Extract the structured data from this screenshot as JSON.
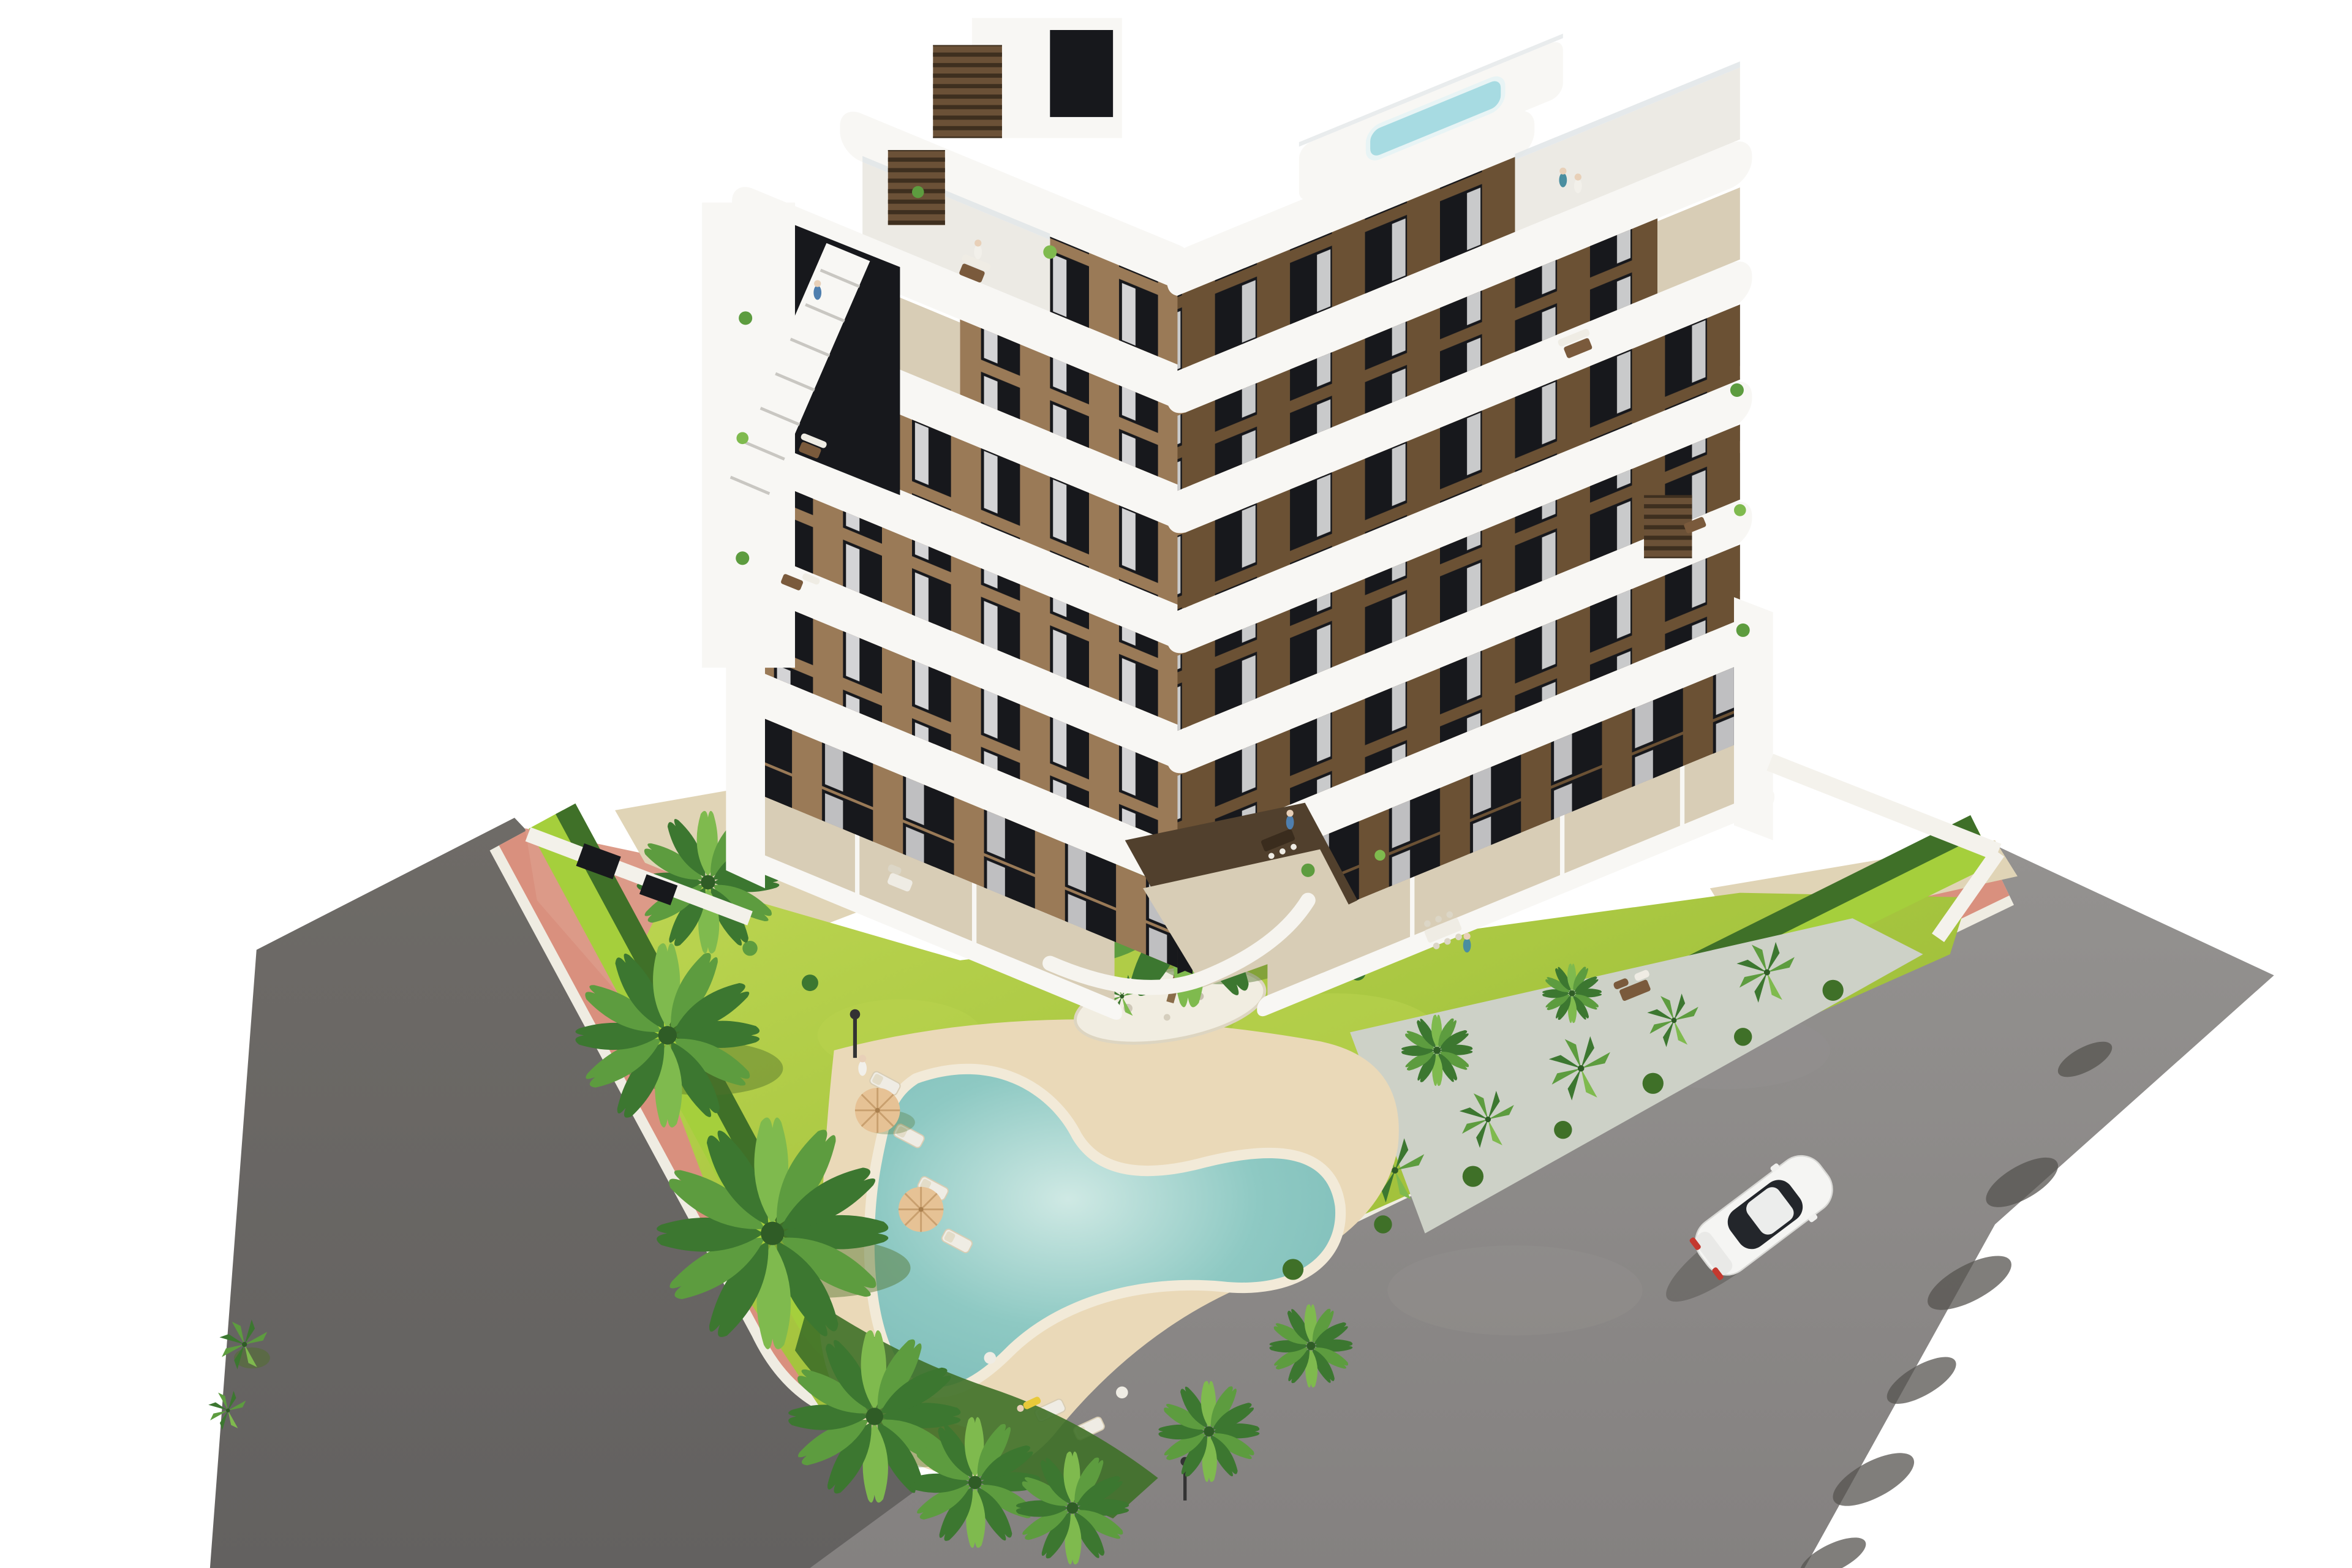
{
  "scene": {
    "type": "architectural-render-aerial",
    "description": "Aerial 3D render of a modern V-shaped apartment building with white curved balcony bands and brown facades, communal garden with lawn, palm trees, free-form sand-edged pool with loungers and tan umbrellas, surrounded by a pink paver sidewalk, gray asphalt roads and a single white car; isolated on a white background",
    "objects": {
      "building": "six-story apartment block, two wings meeting at a corner, white wrap-around balconies, brown walls, rooftop terraces, rooftop plunge pool, slatted chimney boxes, external stair tower",
      "garden": "lawn with white-gravel palm island, hedges, gravel planting bed with yuccas",
      "pool": "boomerang-shaped turquoise pool with beige sand deck, four loungers, two tan umbrellas, garden lamps",
      "streets": "pink paver sidewalk with white curbs wrapping the plot, dark asphalt road left, lighter asphalt road right with tree shadows",
      "car": "white coupe driving on right road, dark glass roof, red taillights",
      "people": "small figures on terraces, rooftop and pool deck"
    }
  },
  "colors": {
    "background": "#ffffff",
    "asphalt": "#848180",
    "asphalt_dark": "#6e6b67",
    "asphalt_light": "#949290",
    "asphalt_shadow": "#565450",
    "sidewalk_pink": "#d9907e",
    "sidewalk_pink_light": "#dc9a88",
    "curb_white": "#efece2",
    "sand": "#e0d4b6",
    "deck_sand": "#ead9b8",
    "lawn": "#a5c43e",
    "lawn_deep": "#96b434",
    "lawn_light": "#bcd551",
    "grass_strip": "#a5cf3c",
    "hedge_dark": "#3f7028",
    "gravel": "#cdd1c7",
    "island_gravel": "#f1ede1",
    "pool_rim": "#f2ead8",
    "pool_water": "#8ec9c3",
    "pool_water_light": "#cfe9e4",
    "pool_water_deep": "#7dbcb8",
    "building_white": "#f8f7f4",
    "building_white_dim": "#eceae4",
    "wall_brown_light": "#9a7a57",
    "wall_brown_dark": "#6b5134",
    "window_dark": "#17181c",
    "curtain": "#e9e9ea",
    "roof_glass": "#dfe4e6",
    "plunge_pool": "#a7dbe2",
    "chimney_brown": "#6b5137",
    "chimney_slat": "#3e2f1f",
    "terrace_tile": "#d8cdb6",
    "furniture_brown": "#7a5a3c",
    "furniture_white": "#efece4",
    "umbrella_tan": "#e6c295",
    "umbrella_rib": "#c9a06f",
    "palm_dark": "#3c7730",
    "palm_mid": "#5d9c3f",
    "palm_light": "#7fba4e",
    "palm_shadow": "#50702a",
    "trunk": "#8a6d4a",
    "car_body": "#f5f5f3",
    "car_glass": "#23262b",
    "taillight": "#c4392f",
    "lamp": "#333333",
    "skin": "#e8d0b8",
    "person_blue": "#4f7fae",
    "person_teal": "#4a8ea0",
    "person_white": "#f2f0ea",
    "person_yellow": "#e8c93a"
  }
}
